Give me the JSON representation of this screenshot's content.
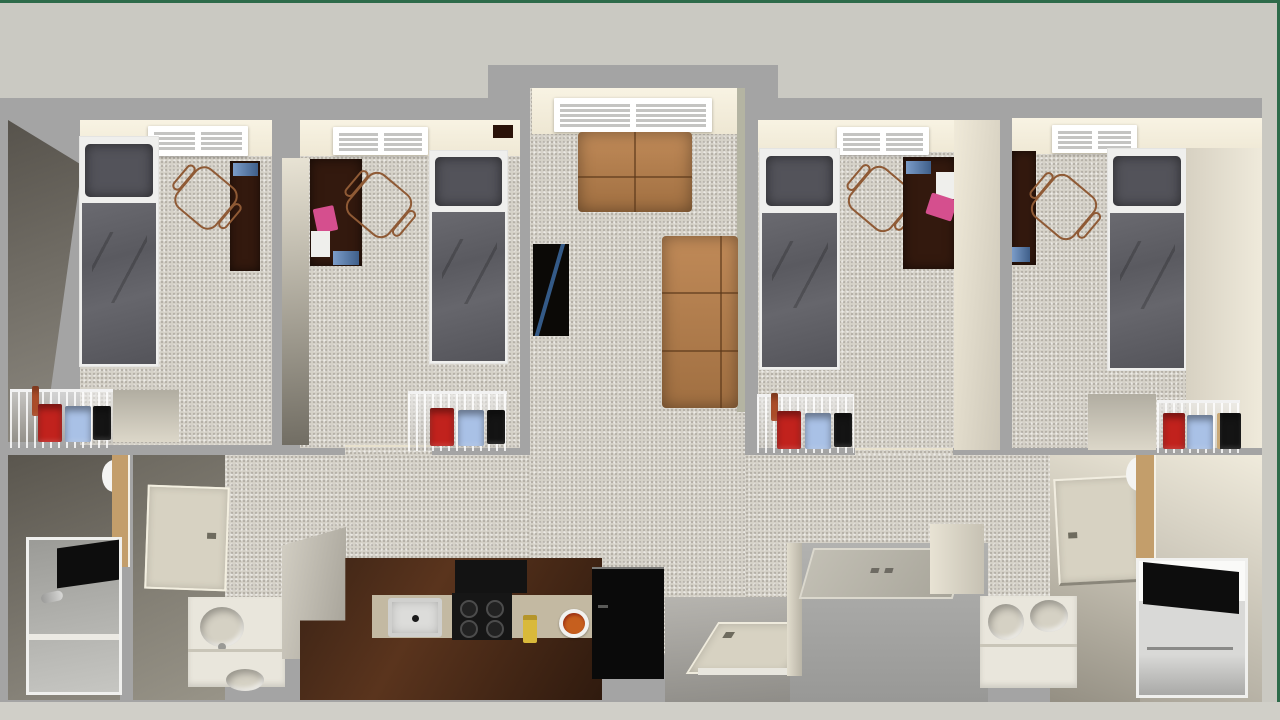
{
  "scene": {
    "kind": "3d-floorplan-render",
    "description": "Top-down 3D dollhouse rendering of a four-bedroom student apartment with central living room, open kitchen, entry, laundry closet and two bathroom suites",
    "rooms": [
      {
        "id": "bedroom-1",
        "furniture": [
          "twin-bed",
          "study-desk",
          "desk-chair",
          "wire-storage-shelf",
          "storage-bins",
          "closet-nook"
        ]
      },
      {
        "id": "bedroom-2",
        "furniture": [
          "twin-bed",
          "study-desk",
          "desk-chair",
          "wire-storage-shelf",
          "storage-bins",
          "pink-notebook",
          "paper-sheet",
          "laptop"
        ]
      },
      {
        "id": "living-room",
        "furniture": [
          "loveseat",
          "three-seat-sofa",
          "tv-media-stand",
          "window"
        ]
      },
      {
        "id": "bedroom-3",
        "furniture": [
          "twin-bed",
          "study-desk",
          "desk-chair",
          "wire-storage-shelf",
          "storage-bins",
          "pink-notebook",
          "paper-sheet",
          "laptop"
        ]
      },
      {
        "id": "bedroom-4",
        "furniture": [
          "twin-bed",
          "study-desk",
          "desk-chair",
          "wire-storage-shelf",
          "storage-bins",
          "closet-nook"
        ]
      },
      {
        "id": "kitchen",
        "furniture": [
          "half-wall",
          "l-shaped-counter",
          "kitchen-sink",
          "cooktop",
          "paper-towel-holder",
          "food-plate",
          "refrigerator"
        ]
      },
      {
        "id": "entry",
        "furniture": [
          "front-door"
        ]
      },
      {
        "id": "laundry-closet",
        "furniture": [
          "closet-door"
        ]
      },
      {
        "id": "bathroom-west",
        "furniture": [
          "toilet",
          "walk-in-shower",
          "shower-head",
          "black-towel",
          "door",
          "sink-vanity"
        ]
      },
      {
        "id": "bathroom-east",
        "furniture": [
          "toilet",
          "walk-in-shower",
          "black-towel",
          "door",
          "double-sink-vanity"
        ]
      }
    ]
  },
  "palette": {
    "border_green": "#2e6b4a",
    "background_band": "#cac9c2",
    "bottom_band": "#d0cfc8",
    "plan_gray": "#a4a4a4",
    "carpet": "#d6d2c9",
    "ceiling_cream": "#f6f0de",
    "wall_cream": "#ded8c9",
    "wall_shadow": "#6b675e",
    "window_white": "#fdfdfd",
    "bed_pillow": "#53535a",
    "bed_linen": "#5f5f65",
    "mattress_white": "#efefed",
    "desk_wood": "#33190e",
    "chair_outline": "#8f5a35",
    "sofa_leather": "#b07c4e",
    "tv_black": "#0b0906",
    "tv_reflection_blue": "#3f6fa8",
    "bin_red": "#c1221d",
    "bin_blue": "#a9c1e6",
    "bin_black": "#141414",
    "bin_orange": "#c2542a",
    "notebook_pink": "#d54f8e",
    "paper_white": "#efefec",
    "laptop_blue": "#4a6fa5",
    "counter_wood": "#3b2315",
    "countertop_beige": "#c3b9a2",
    "sink_steel": "#bcbcba",
    "cooktop_black": "#161616",
    "dispenser_yellow": "#d9b93a",
    "fridge_black": "#0a0a0a",
    "food_orange": "#c65f1e",
    "vanity_white": "#e9e6dc",
    "sink_bowl": "#d5d1c4",
    "door_beige": "#d7d2c2",
    "wood_trim": "#c39e6b",
    "towel_black": "#0d0d0d",
    "entry_floor": "#a3a19c",
    "toilet_white": "#f4f4f2"
  }
}
